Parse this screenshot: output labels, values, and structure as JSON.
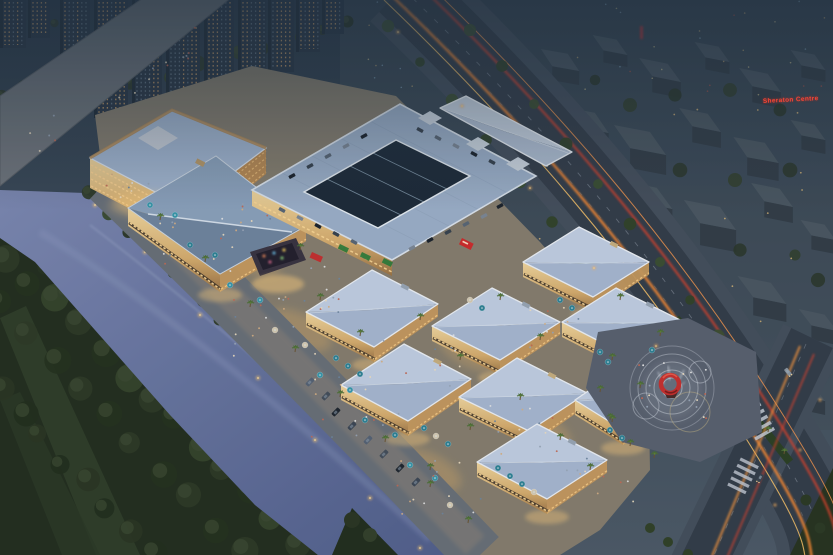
{
  "scene": {
    "type": "aerial-architectural-rendering",
    "subject": "riverside shopping mall complex at dusk",
    "signs": {
      "sheraton": "Sheraton Centre"
    },
    "palette": {
      "sky_dusk": "#31404f",
      "city_block_top": "#4b5761",
      "city_block_side": "#333d47",
      "tower_facade": "#2b3744",
      "window_warm": "#e8b06e",
      "river": "#66739e",
      "park_green": "#242e1e",
      "tree_green": "#2f3b28",
      "mall_roof_blue": "#b6c4db",
      "roof_parapet_white": "#eef2f7",
      "facade_warm": "#e3c084",
      "storefront_glow": "#ffd98f",
      "umbrella_teal": "#2f8396",
      "asphalt": "#343d49",
      "light_trail_orange": "#ff8c32",
      "light_trail_red": "#e2432a",
      "sculpture_red": "#c8302e",
      "sign_red": "#ff4836",
      "plaza_grey": "#5a616f"
    }
  }
}
